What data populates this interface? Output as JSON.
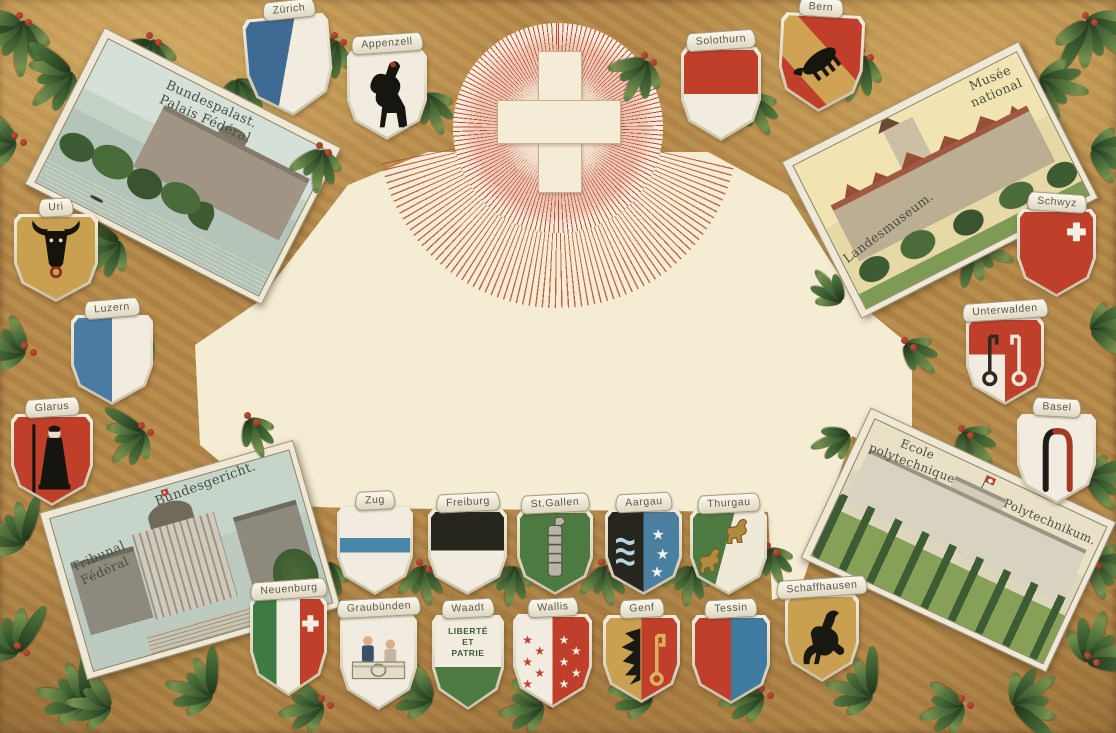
{
  "postcard": {
    "country": "Switzerland",
    "style": "embossed chromolithograph greeting postcard",
    "center_motif": "white Swiss cross on a red radiant sun",
    "border_motif": "gold ground with laurel garlands and red berries"
  },
  "palette": {
    "gold": "#b38748",
    "cream": "#f4ecd3",
    "swiss_red": "#bf3f2b",
    "ray_red": "#bf4530",
    "leaf_green_dark": "#2e4827",
    "leaf_green_light": "#77914e",
    "berry_red": "#8f2c1c",
    "silver_edge": "#ded7c2",
    "banner_text": "#59594a"
  },
  "vignettes": [
    {
      "id": "bundespalast",
      "lines": [
        "Bundespalast.",
        "Palais Fédéral"
      ]
    },
    {
      "id": "landesmuseum",
      "lines": [
        "Landesmuseum.",
        "Musée",
        "national"
      ]
    },
    {
      "id": "bundesgericht",
      "lines": [
        "Bundesgericht.",
        "Tribunal",
        "Fédéral"
      ]
    },
    {
      "id": "polytechnikum",
      "lines": [
        "Ecole",
        "polytechnique",
        "Polytechnikum."
      ]
    }
  ],
  "shields": [
    {
      "id": "zurich",
      "label": "Zürich",
      "charge": "per-bend blue and white"
    },
    {
      "id": "appenzell",
      "label": "Appenzell",
      "charge": "black bear rampant"
    },
    {
      "id": "bern",
      "label": "Bern",
      "charge": "black bear on gold bend"
    },
    {
      "id": "solothurn",
      "label": "Solothurn",
      "charge": "red over white"
    },
    {
      "id": "uri",
      "label": "Uri",
      "charge": "black bull's head"
    },
    {
      "id": "luzern",
      "label": "Luzern",
      "charge": "blue and white pale"
    },
    {
      "id": "glarus",
      "label": "Glarus",
      "charge": "St. Fridolin with staff"
    },
    {
      "id": "schwyz",
      "label": "Schwyz",
      "charge": "red with white cross"
    },
    {
      "id": "unterwalden",
      "label": "Unterwalden",
      "charge": "two keys"
    },
    {
      "id": "basel",
      "label": "Basel",
      "charge": "two croziers"
    },
    {
      "id": "zug",
      "label": "Zug",
      "charge": "blue fess on white"
    },
    {
      "id": "freiburg",
      "label": "Freiburg",
      "charge": "black over white"
    },
    {
      "id": "stgallen",
      "label": "St.Gallen",
      "charge": "fasces on green"
    },
    {
      "id": "aargau",
      "label": "Aargau",
      "charge": "waves and three stars"
    },
    {
      "id": "thurgau",
      "label": "Thurgau",
      "charge": "two gold lions on bend"
    },
    {
      "id": "neuenburg",
      "label": "Neuenburg",
      "charge": "green-white-red with white cross"
    },
    {
      "id": "graubuenden",
      "label": "Graubünden",
      "charge": "league figures"
    },
    {
      "id": "waadt",
      "label": "Waadt",
      "charge": "motto on white over green",
      "motto_lines": [
        "LIBERTÉ",
        "ET",
        "PATRIE"
      ]
    },
    {
      "id": "wallis",
      "label": "Wallis",
      "charge": "counterchanged stars"
    },
    {
      "id": "genf",
      "label": "Genf",
      "charge": "half eagle and gold key"
    },
    {
      "id": "tessin",
      "label": "Tessin",
      "charge": "red and blue pale"
    },
    {
      "id": "schaffhausen",
      "label": "Schaffhausen",
      "charge": "black ram"
    }
  ]
}
